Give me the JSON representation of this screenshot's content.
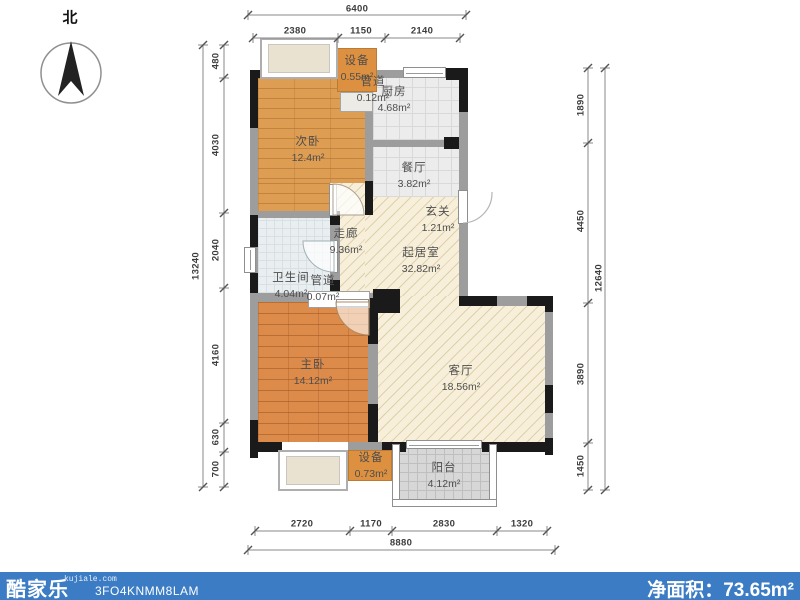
{
  "compass": {
    "label": "北"
  },
  "rooms": {
    "shebei_top": {
      "name": "设备",
      "area": "0.55m²"
    },
    "guandao_top": {
      "name": "管道",
      "area": "0.12m²"
    },
    "chufang": {
      "name": "厨房",
      "area": "4.68m²"
    },
    "ciwo": {
      "name": "次卧",
      "area": "12.4m²"
    },
    "canting": {
      "name": "餐厅",
      "area": "3.82m²"
    },
    "xuanguan": {
      "name": "玄关",
      "area": "1.21m²"
    },
    "zoulang": {
      "name": "走廊",
      "area": "9.36m²"
    },
    "weishengjian": {
      "name": "卫生间",
      "area": "4.04m²"
    },
    "guandao_bottom": {
      "name": "管道",
      "area": "0.07m²"
    },
    "qijushi": {
      "name": "起居室",
      "area": "32.82m²"
    },
    "zhuwo": {
      "name": "主卧",
      "area": "14.12m²"
    },
    "keting": {
      "name": "客厅",
      "area": "18.56m²"
    },
    "shebei_bottom": {
      "name": "设备",
      "area": "0.73m²"
    },
    "yangtai": {
      "name": "阳台",
      "area": "4.12m²"
    }
  },
  "dimensions": {
    "top": {
      "total": "6400",
      "segments": [
        "2380",
        "1150",
        "2140"
      ]
    },
    "bottom": {
      "total": "8880",
      "segments": [
        "2720",
        "1170",
        "2830",
        "1320"
      ]
    },
    "left": {
      "total": "13240",
      "segments": [
        "480",
        "4030",
        "2040",
        "4160",
        "630",
        "700"
      ]
    },
    "right": {
      "total": "12640",
      "segments": [
        "1890",
        "4450",
        "3890",
        "1450"
      ]
    }
  },
  "footer": {
    "logo": "酷家乐",
    "website": "kujiale.com",
    "plan_code": "3FO4KNMM8LAM",
    "net_area_label": "净面积：",
    "net_area_value": "73.65m²"
  },
  "colors": {
    "accent-blue": "#3b7cc4",
    "wall-dark": "#1a1a1a",
    "wall-gray": "#9d9d9d",
    "wood-light": "#dd9d52",
    "wood-dark": "#dc8b4a",
    "hatch-beige": "#f7efd9",
    "tile-gray": "#ececec",
    "tile-bath": "#e9eef0",
    "balcony-gray": "#d7d7d7",
    "equip-orange": "#dd9040"
  }
}
